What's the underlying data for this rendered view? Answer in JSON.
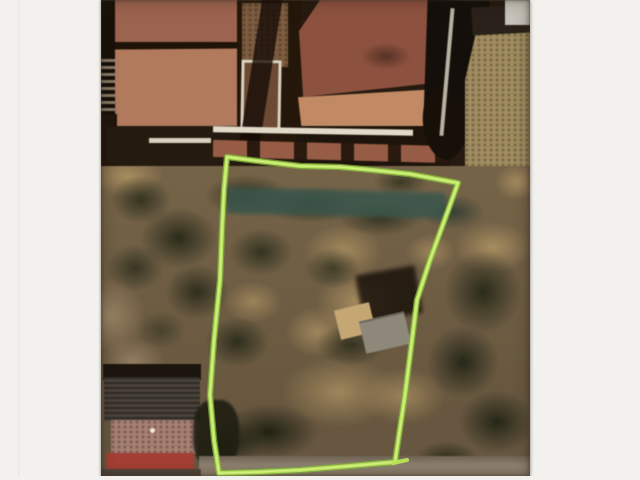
{
  "meta": {
    "description": "Photograph of a printed aerial photo: a vacant scrubland parcel outlined in bright green marker, terracotta-roofed houses along the top edge, a dark-roofed building with a red-edged annex at lower left, small tan and gray sheds inside the plot, and white paper margins on the left and right sides."
  },
  "photo": {
    "left_px": 101,
    "top_px": 0,
    "width_px": 429,
    "height_px": 476
  },
  "boundary": {
    "points": "227,157 258,161 300,166 340,167 372,170 410,174 458,183 442,227 430,260 417,300 412,340 405,395 399,435 395,462 350,466 300,470 258,472 219,473 214,440 210,395 214,340 220,280 222,230 224,190",
    "overshoot": "393,463 407,460",
    "stroke_width": 5
  },
  "colors": {
    "paper": "#f2f1ee",
    "photo-base": "#77654a",
    "roof-terracotta": "#9b6350",
    "roof-terracotta-light": "#b07a5e",
    "roof-terracotta-dark": "#8c5240",
    "roof-salmon": "#c08a66",
    "white-wall": "#e2dac8",
    "khaki-ground": "#a18d61",
    "teal-hedge": "#3a564c",
    "shed-tan": "#c4a775",
    "shed-gray": "#8e887a",
    "building-gray-roof": "#4a423a",
    "building-pink-roof": "#a68073",
    "building-red-strip": "#a23f36",
    "road-gray": "#8e8170",
    "boundary-green": "#b9e35b",
    "boundary-core": "#d8f28c",
    "boundary-edge": "#7fae3e"
  }
}
